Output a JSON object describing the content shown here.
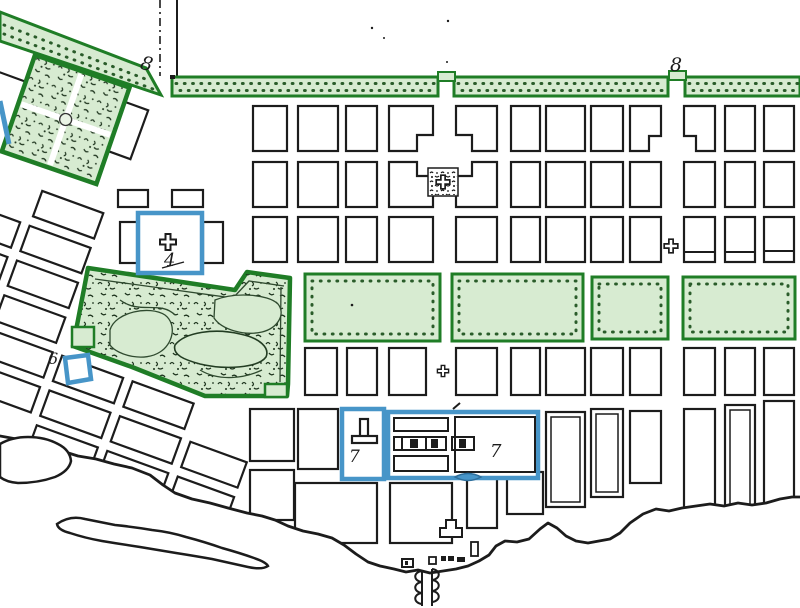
{
  "map": {
    "title": "historic-city-plan",
    "labels": {
      "boulevard_diagonal": "8",
      "esplanade_top": "8",
      "cathedral_square": "4",
      "site_six": "6",
      "site_seven_left": "7",
      "site_seven_right": "7"
    },
    "colors": {
      "ink": "#1c1c1c",
      "green_border": "#1f7d26",
      "green_fill": "#d7ebd1",
      "green_mark": "#2a5c2a",
      "park_line": "#2f4a2f",
      "blue": "#4795c8",
      "blue_dark": "#2e6f9c"
    }
  }
}
